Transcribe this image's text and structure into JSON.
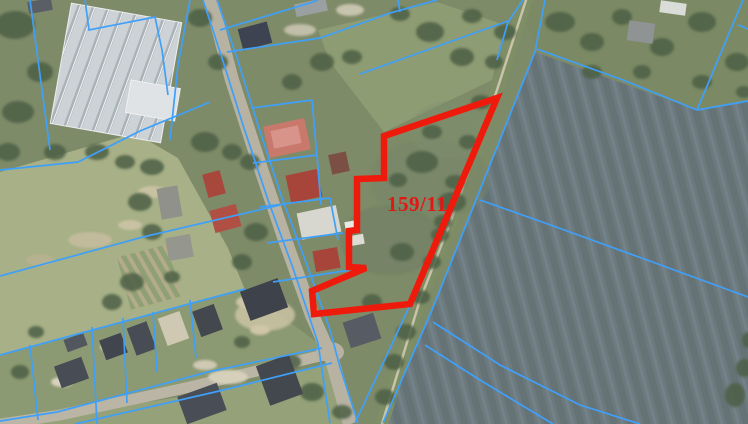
{
  "map": {
    "type": "cadastral-aerial-map",
    "parcel": {
      "label": "159/11",
      "label_color": "#e01812",
      "label_anchor": [
        387,
        211
      ],
      "outline_color": "#ee1b0d",
      "outline_width": 6.5,
      "outline": [
        [
          497,
          98
        ],
        [
          384,
          136
        ],
        [
          384,
          178
        ],
        [
          357,
          179
        ],
        [
          357,
          230
        ],
        [
          349,
          231
        ],
        [
          349,
          267
        ],
        [
          366,
          268
        ],
        [
          312,
          291
        ],
        [
          314,
          314
        ],
        [
          410,
          304
        ]
      ]
    },
    "cadastral_line_color": "#3fa0fa",
    "cadastral_line_width": 1.7,
    "cadastral_lines": [
      [
        [
          203,
          0
        ],
        [
          222,
          58
        ],
        [
          243,
          125
        ],
        [
          268,
          200
        ],
        [
          293,
          268
        ],
        [
          318,
          343
        ],
        [
          330,
          423
        ]
      ],
      [
        [
          217,
          0
        ],
        [
          237,
          58
        ],
        [
          258,
          125
        ],
        [
          282,
          198
        ],
        [
          307,
          265
        ],
        [
          330,
          330
        ],
        [
          340,
          367
        ],
        [
          358,
          423
        ]
      ],
      [
        [
          409,
          307
        ],
        [
          393,
          342
        ],
        [
          355,
          423
        ]
      ],
      [
        [
          545,
          0
        ],
        [
          535,
          52
        ],
        [
          470,
          215
        ],
        [
          432,
          310
        ],
        [
          383,
          423
        ]
      ],
      [
        [
          322,
          348
        ],
        [
          208,
          372
        ],
        [
          57,
          412
        ],
        [
          0,
          421
        ]
      ],
      [
        [
          332,
          363
        ],
        [
          215,
          392
        ],
        [
          75,
          424
        ]
      ],
      [
        [
          537,
          49
        ],
        [
          623,
          80
        ],
        [
          697,
          110
        ]
      ],
      [
        [
          697,
          110
        ],
        [
          748,
          101
        ]
      ],
      [
        [
          743,
          0
        ],
        [
          697,
          110
        ]
      ],
      [
        [
          738,
          25
        ],
        [
          748,
          29
        ]
      ],
      [
        [
          480,
          200
        ],
        [
          545,
          223
        ],
        [
          647,
          260
        ],
        [
          748,
          297
        ]
      ],
      [
        [
          433,
          322
        ],
        [
          500,
          365
        ],
        [
          580,
          405
        ],
        [
          640,
          424
        ]
      ],
      [
        [
          425,
          345
        ],
        [
          480,
          380
        ],
        [
          553,
          424
        ]
      ],
      [
        [
          360,
          74
        ],
        [
          508,
          21
        ]
      ],
      [
        [
          523,
          0
        ],
        [
          508,
          22
        ],
        [
          497,
          60
        ]
      ],
      [
        [
          30,
          0
        ],
        [
          38,
          60
        ],
        [
          50,
          150
        ]
      ],
      [
        [
          85,
          0
        ],
        [
          89,
          30
        ],
        [
          155,
          17
        ],
        [
          162,
          50
        ],
        [
          168,
          95
        ]
      ],
      [
        [
          190,
          0
        ],
        [
          178,
          65
        ],
        [
          170,
          140
        ]
      ],
      [
        [
          0,
          170
        ],
        [
          78,
          162
        ],
        [
          140,
          131
        ],
        [
          210,
          102
        ]
      ],
      [
        [
          0,
          276
        ],
        [
          143,
          237
        ],
        [
          280,
          205
        ]
      ],
      [
        [
          0,
          355
        ],
        [
          200,
          301
        ],
        [
          245,
          289
        ]
      ],
      [
        [
          30,
          345
        ],
        [
          38,
          420
        ]
      ],
      [
        [
          92,
          327
        ],
        [
          97,
          424
        ]
      ],
      [
        [
          123,
          318
        ],
        [
          127,
          403
        ]
      ],
      [
        [
          153,
          312
        ],
        [
          157,
          372
        ]
      ],
      [
        [
          190,
          300
        ],
        [
          196,
          358
        ]
      ],
      [
        [
          220,
          30
        ],
        [
          310,
          3
        ],
        [
          318,
          0
        ]
      ],
      [
        [
          227,
          52
        ],
        [
          320,
          38
        ],
        [
          390,
          13
        ],
        [
          437,
          0
        ]
      ],
      [
        [
          398,
          0
        ],
        [
          400,
          12
        ]
      ],
      [
        [
          252,
          108
        ],
        [
          312,
          100
        ]
      ],
      [
        [
          312,
          100
        ],
        [
          317,
          157
        ]
      ],
      [
        [
          253,
          163
        ],
        [
          317,
          155
        ]
      ],
      [
        [
          317,
          155
        ],
        [
          321,
          205
        ]
      ],
      [
        [
          260,
          207
        ],
        [
          330,
          198
        ]
      ],
      [
        [
          330,
          198
        ],
        [
          338,
          240
        ]
      ],
      [
        [
          267,
          243
        ],
        [
          343,
          233
        ]
      ],
      [
        [
          273,
          282
        ],
        [
          350,
          270
        ]
      ]
    ]
  }
}
